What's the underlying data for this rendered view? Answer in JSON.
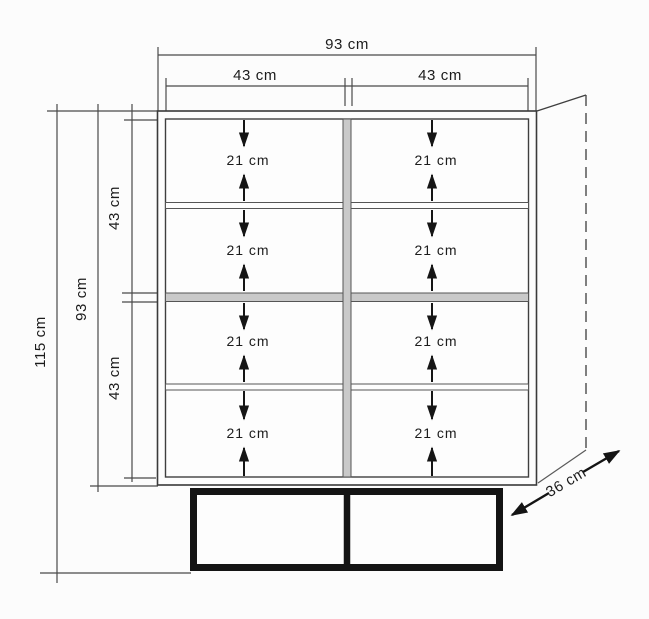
{
  "drawing": {
    "type": "furniture-dimension-diagram",
    "subject": "two-column eight-compartment cabinet on plinth base",
    "unit": "cm",
    "dimensions": {
      "top": {
        "overall_width": "93 cm",
        "left_column_width": "43 cm",
        "right_column_width": "43 cm"
      },
      "left": {
        "total_height": "115 cm",
        "cabinet_height": "93 cm",
        "upper_section_height": "43 cm",
        "lower_section_height": "43 cm"
      },
      "depth": "36 cm",
      "compartments": [
        {
          "label": "21 cm"
        },
        {
          "label": "21 cm"
        },
        {
          "label": "21 cm"
        },
        {
          "label": "21 cm"
        },
        {
          "label": "21 cm"
        },
        {
          "label": "21 cm"
        },
        {
          "label": "21 cm"
        },
        {
          "label": "21 cm"
        }
      ]
    },
    "colors": {
      "line": "#3a3a3a",
      "shelf_fill": "#c9c9c9",
      "base": "#141414",
      "background": "#fcfcfc"
    }
  }
}
